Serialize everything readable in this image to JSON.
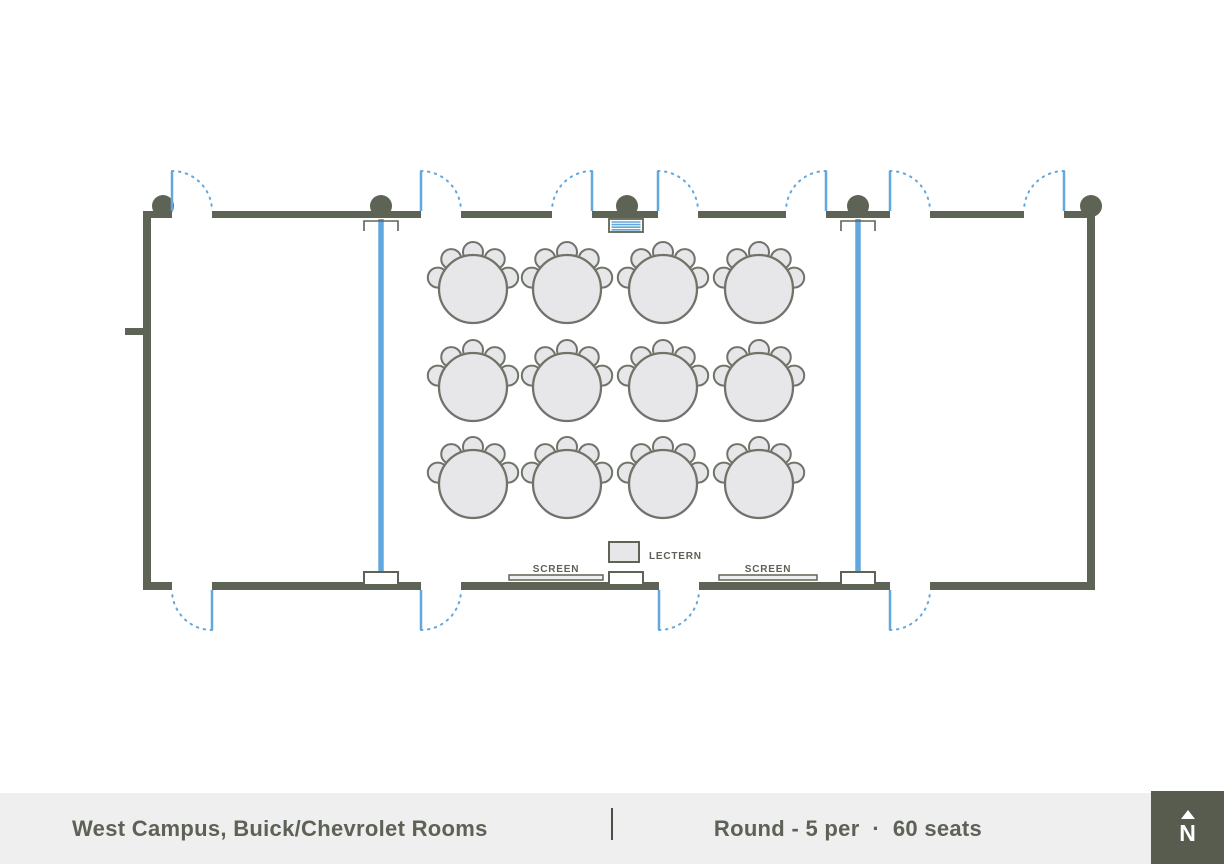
{
  "footer": {
    "left_title": "West Campus, Buick/Chevrolet Rooms",
    "right_title": "Round - 5 per  ·  60 seats",
    "compass_label": "N",
    "bg": "#efefef",
    "text_color": "#5d6256",
    "divider_color": "#4b4f43",
    "compass_bg": "#575c4e"
  },
  "plan_labels": {
    "screen_left": "SCREEN",
    "screen_right": "SCREEN",
    "lectern": "LECTERN"
  },
  "colors": {
    "wall": "#5e6455",
    "accent_blue": "#62a7dd",
    "table_fill": "#e7e7e9",
    "table_stroke": "#6f746a",
    "pocket_fill": "#ffffff",
    "screen_fill": "#f0f0f1",
    "label": "#5d6256"
  },
  "floorplan": {
    "summary": {
      "tables": 12,
      "seats_per_table": 5,
      "total_seats": 60
    },
    "top_wall": {
      "y": 211,
      "h": 7,
      "segments": [
        [
          143,
          172
        ],
        [
          212,
          421
        ],
        [
          461,
          552
        ],
        [
          592,
          658
        ],
        [
          698,
          786
        ],
        [
          826,
          890
        ],
        [
          930,
          1024
        ],
        [
          1064,
          1095
        ]
      ]
    },
    "bottom_wall": {
      "y": 582,
      "h": 8,
      "segments": [
        [
          143,
          172
        ],
        [
          212,
          421
        ],
        [
          461,
          659
        ],
        [
          699,
          890
        ],
        [
          930,
          1095
        ]
      ]
    },
    "left_wall": {
      "x": 143,
      "y": 211,
      "w": 8,
      "h": 379
    },
    "right_wall": {
      "x": 1087,
      "y": 211,
      "w": 8,
      "h": 379
    },
    "wall_stub": {
      "x": 125,
      "y": 328,
      "w": 20,
      "h": 7
    },
    "door_len": 40,
    "top_doors": [
      {
        "x": 172,
        "dir": 1
      },
      {
        "x": 421,
        "dir": 1
      },
      {
        "x": 592,
        "dir": -1
      },
      {
        "x": 658,
        "dir": 1
      },
      {
        "x": 826,
        "dir": -1
      },
      {
        "x": 890,
        "dir": 1
      },
      {
        "x": 1064,
        "dir": -1
      }
    ],
    "bottom_doors": [
      {
        "x": 212,
        "dir": -1
      },
      {
        "x": 421,
        "dir": 1
      },
      {
        "x": 659,
        "dir": 1
      },
      {
        "x": 890,
        "dir": 1
      }
    ],
    "air_walls": {
      "x": [
        381,
        858
      ],
      "y1": 219,
      "y2": 573,
      "width": 5.5
    },
    "top_brackets": [
      381,
      858
    ],
    "bottom_pockets": [
      364,
      609,
      841
    ],
    "pocket": {
      "w": 34,
      "h": 13,
      "y": 572
    },
    "equipment_box": {
      "x": 609,
      "y": 219,
      "w": 34,
      "h": 13,
      "stripes": 4
    },
    "columns": {
      "cy": 206,
      "r": 11,
      "cx": [
        163,
        381,
        627,
        858,
        1091
      ]
    },
    "tables": {
      "cols": [
        473,
        567,
        663,
        759
      ],
      "rows": [
        289,
        387,
        484
      ],
      "radius": 34,
      "chair_orbit": 37,
      "chair_radius": 10,
      "chair_angles": [
        -72,
        -36,
        0,
        36,
        72
      ]
    },
    "screens": [
      {
        "x": 509,
        "y": 575,
        "w": 94,
        "h": 5
      },
      {
        "x": 719,
        "y": 575,
        "w": 98,
        "h": 5
      }
    ],
    "lectern": {
      "x": 609,
      "y": 542,
      "w": 30,
      "h": 20
    }
  }
}
